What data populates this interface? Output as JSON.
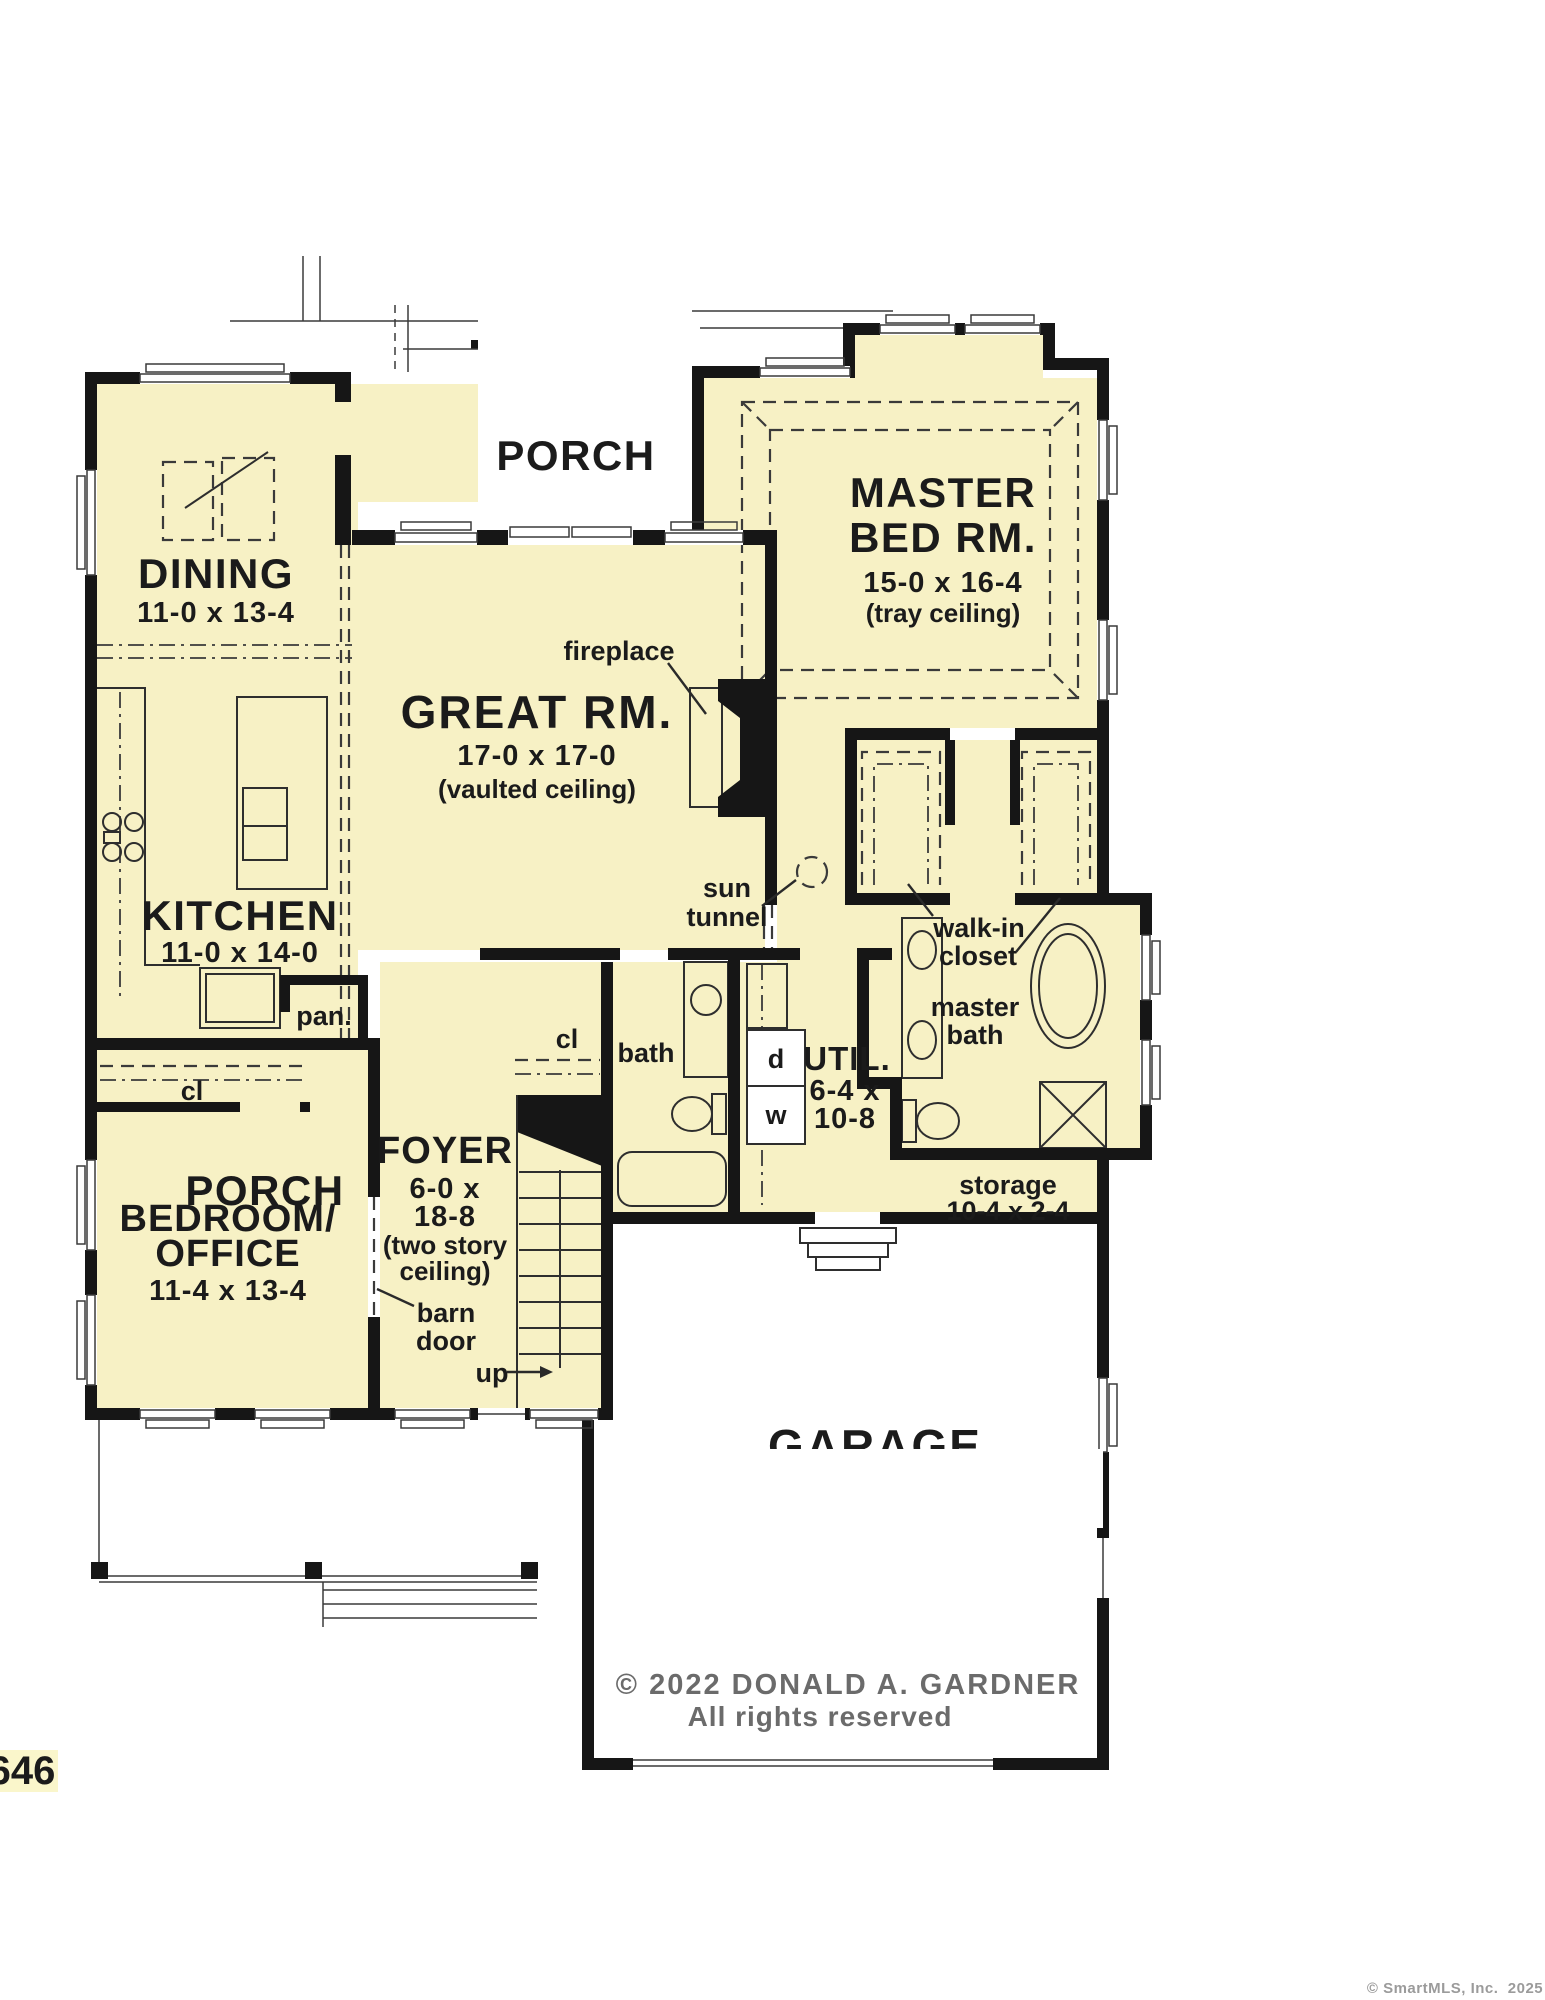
{
  "colors": {
    "fill": "#F7F1C5",
    "wall": "#161616",
    "line": "#3a3a3a",
    "text": "#1b1b1b",
    "muted": "#6b6b6b",
    "watermark": "#9b9b9b",
    "chip": "#FAF6CB"
  },
  "rooms": {
    "porch_top": {
      "label": "PORCH"
    },
    "master_bedroom": {
      "line1": "MASTER",
      "line2": "BED RM.",
      "dims": "15-0 x 16-4",
      "note": "(tray ceiling)"
    },
    "dining": {
      "label": "DINING",
      "dims": "11-0 x 13-4"
    },
    "great_room": {
      "label": "GREAT RM.",
      "dims": "17-0 x 17-0",
      "note": "(vaulted ceiling)"
    },
    "kitchen": {
      "label": "KITCHEN",
      "dims": "11-0 x 14-0"
    },
    "pantry": {
      "label": "pan."
    },
    "utility": {
      "label": "UTIL.",
      "dims_line1": "6-4 x",
      "dims_line2": "10-8"
    },
    "bath": {
      "label": "bath"
    },
    "foyer": {
      "label": "FOYER",
      "dims_line1": "6-0 x",
      "dims_line2": "18-8",
      "note_line1": "(two story",
      "note_line2": "ceiling)"
    },
    "bedroom_office": {
      "line1": "BEDROOM/",
      "line2": "OFFICE",
      "dims": "11-4 x 13-4"
    },
    "walk_in_closet": {
      "line1": "walk-in",
      "line2": "closet"
    },
    "master_bath": {
      "line1": "master",
      "line2": "bath"
    },
    "storage": {
      "label": "storage",
      "dims": "10-4 x 2-4"
    },
    "garage": {
      "label": "GARAGE"
    },
    "porch_bottom": {
      "label": "PORCH"
    }
  },
  "annotations": {
    "fireplace": "fireplace",
    "sun_tunnel_line1": "sun",
    "sun_tunnel_line2": "tunnel",
    "barn_door_line1": "barn",
    "barn_door_line2": "door",
    "up": "up",
    "closet_foyer": "cl",
    "closet_bedroom": "cl",
    "dryer": "d",
    "washer": "w"
  },
  "footer": {
    "copyright_line1": "© 2022 DONALD A. GARDNER",
    "copyright_line2": "All rights reserved",
    "plan_number": "646",
    "watermark": "© SmartMLS, Inc.  2025"
  }
}
